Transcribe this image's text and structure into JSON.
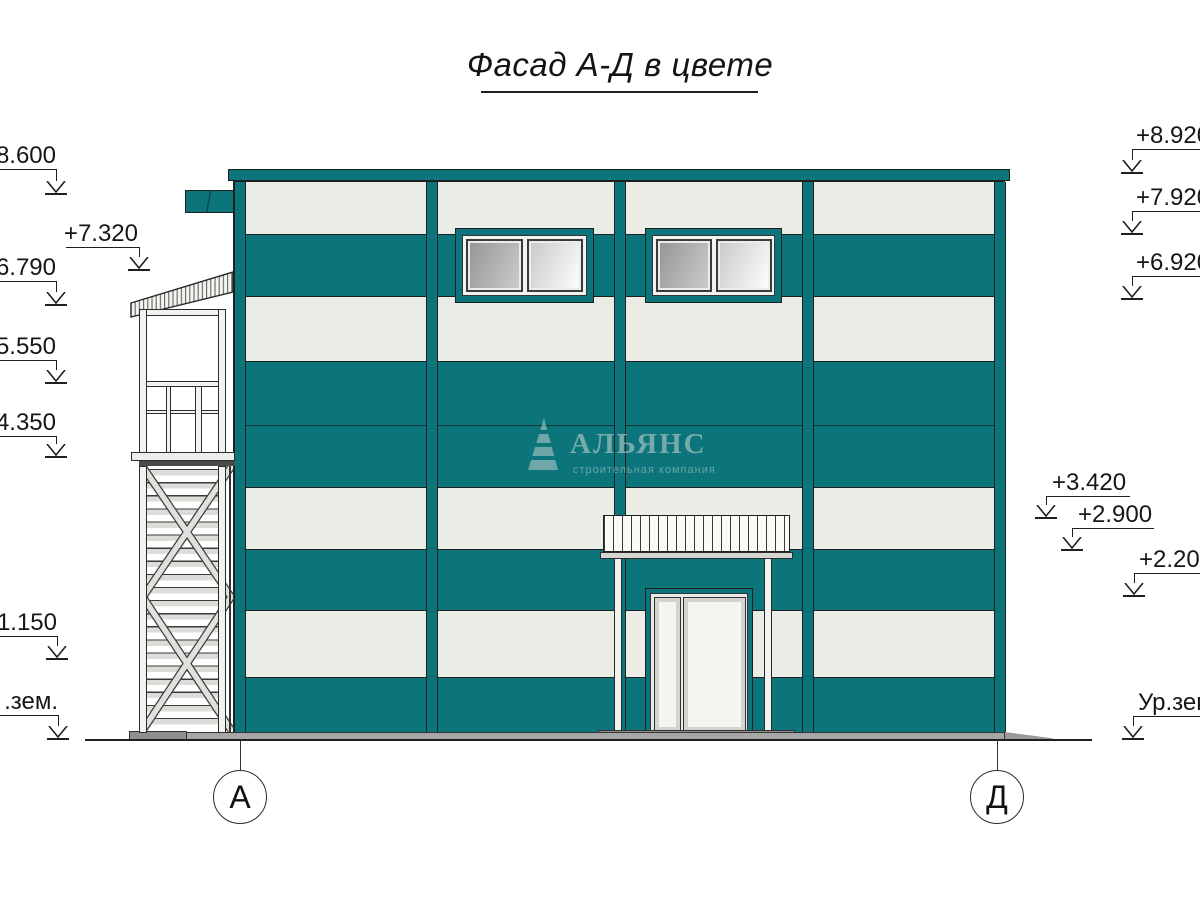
{
  "title": {
    "text": "Фасад А-Д в цвете"
  },
  "colors": {
    "teal": "#0c747b",
    "light_panel": "#ecece7",
    "outline": "#1f1f1f",
    "base_gray": "#a6a6a6",
    "dark_gray": "#8f8f8f",
    "glass_dark_start": "#949494",
    "glass_dark_end": "#cdcdcd",
    "glass_light_start": "#c8c8c8",
    "glass_light_end": "#ffffff"
  },
  "elevation_markers": {
    "left": [
      {
        "label": "8.600"
      },
      {
        "label": "+7.320"
      },
      {
        "label": "6.790"
      },
      {
        "label": "5.550"
      },
      {
        "label": "4.350"
      },
      {
        "label": "1.150"
      },
      {
        "label": ".зем."
      }
    ],
    "right": [
      {
        "label": "+8.920"
      },
      {
        "label": "+7.920"
      },
      {
        "label": "+6.920"
      },
      {
        "label": "+3.420"
      },
      {
        "label": "+2.900"
      },
      {
        "label": "+2.200"
      },
      {
        "label": "Ур.зем."
      }
    ]
  },
  "axes": [
    {
      "label": "А"
    },
    {
      "label": "Д"
    }
  ],
  "watermark": {
    "company": "АЛЬЯНС",
    "tagline": "строительная компания"
  }
}
